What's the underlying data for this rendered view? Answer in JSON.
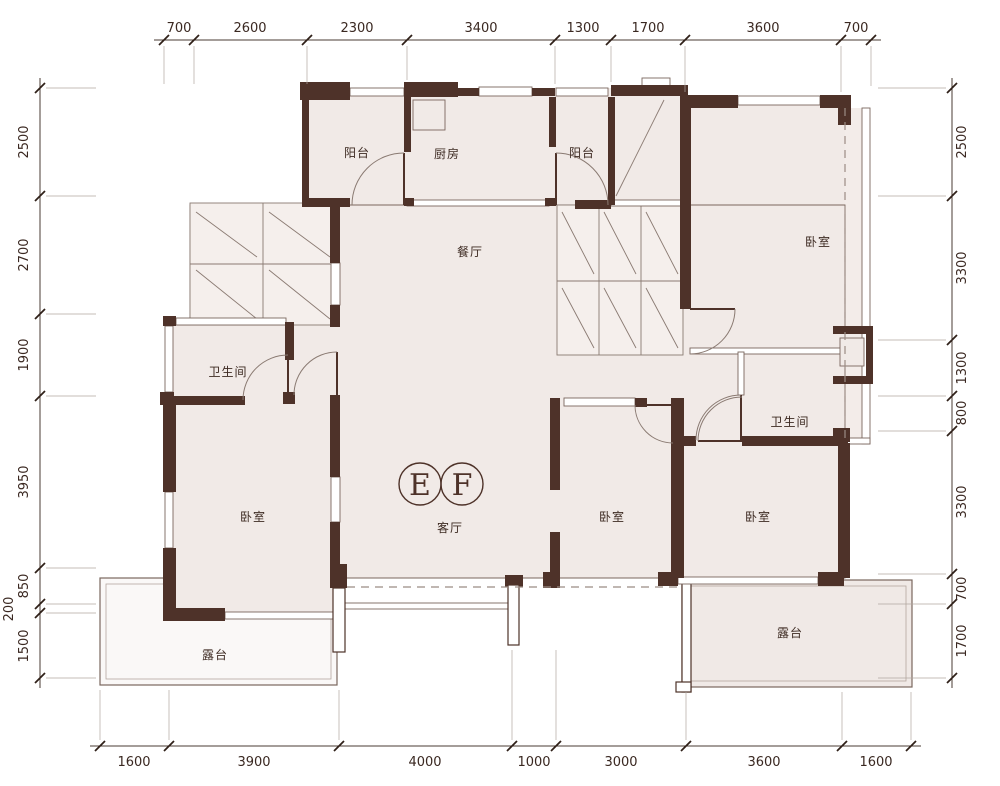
{
  "rooms": {
    "balcony_left": "阳台",
    "kitchen": "厨房",
    "balcony_right": "阳台",
    "dining": "餐厅",
    "bedroom_top_right": "卧室",
    "bath_left": "卫生间",
    "bath_right": "卫生间",
    "living": "客厅",
    "bedroom_left": "卧室",
    "bedroom_mid": "卧室",
    "bedroom_right": "卧室",
    "terrace_left": "露台",
    "terrace_right": "露台"
  },
  "units": {
    "e": "E",
    "f": "F"
  },
  "dims": {
    "top": [
      "700",
      "2600",
      "2300",
      "3400",
      "1300",
      "1700",
      "3600",
      "700"
    ],
    "bottom": [
      "1600",
      "3900",
      "4000",
      "1000",
      "3000",
      "3600",
      "1600"
    ],
    "left": [
      "2500",
      "2700",
      "1900",
      "3950",
      "850",
      "200",
      "1500"
    ],
    "right": [
      "2500",
      "3300",
      "1300",
      "800",
      "3300",
      "700",
      "1700"
    ]
  },
  "colors": {
    "wall": "#4e3229",
    "room_fill": "#f1eae7",
    "terrace_left_fill": "#faf8f7",
    "thin_line": "#7a675e",
    "dim_text": "#3a2821"
  }
}
